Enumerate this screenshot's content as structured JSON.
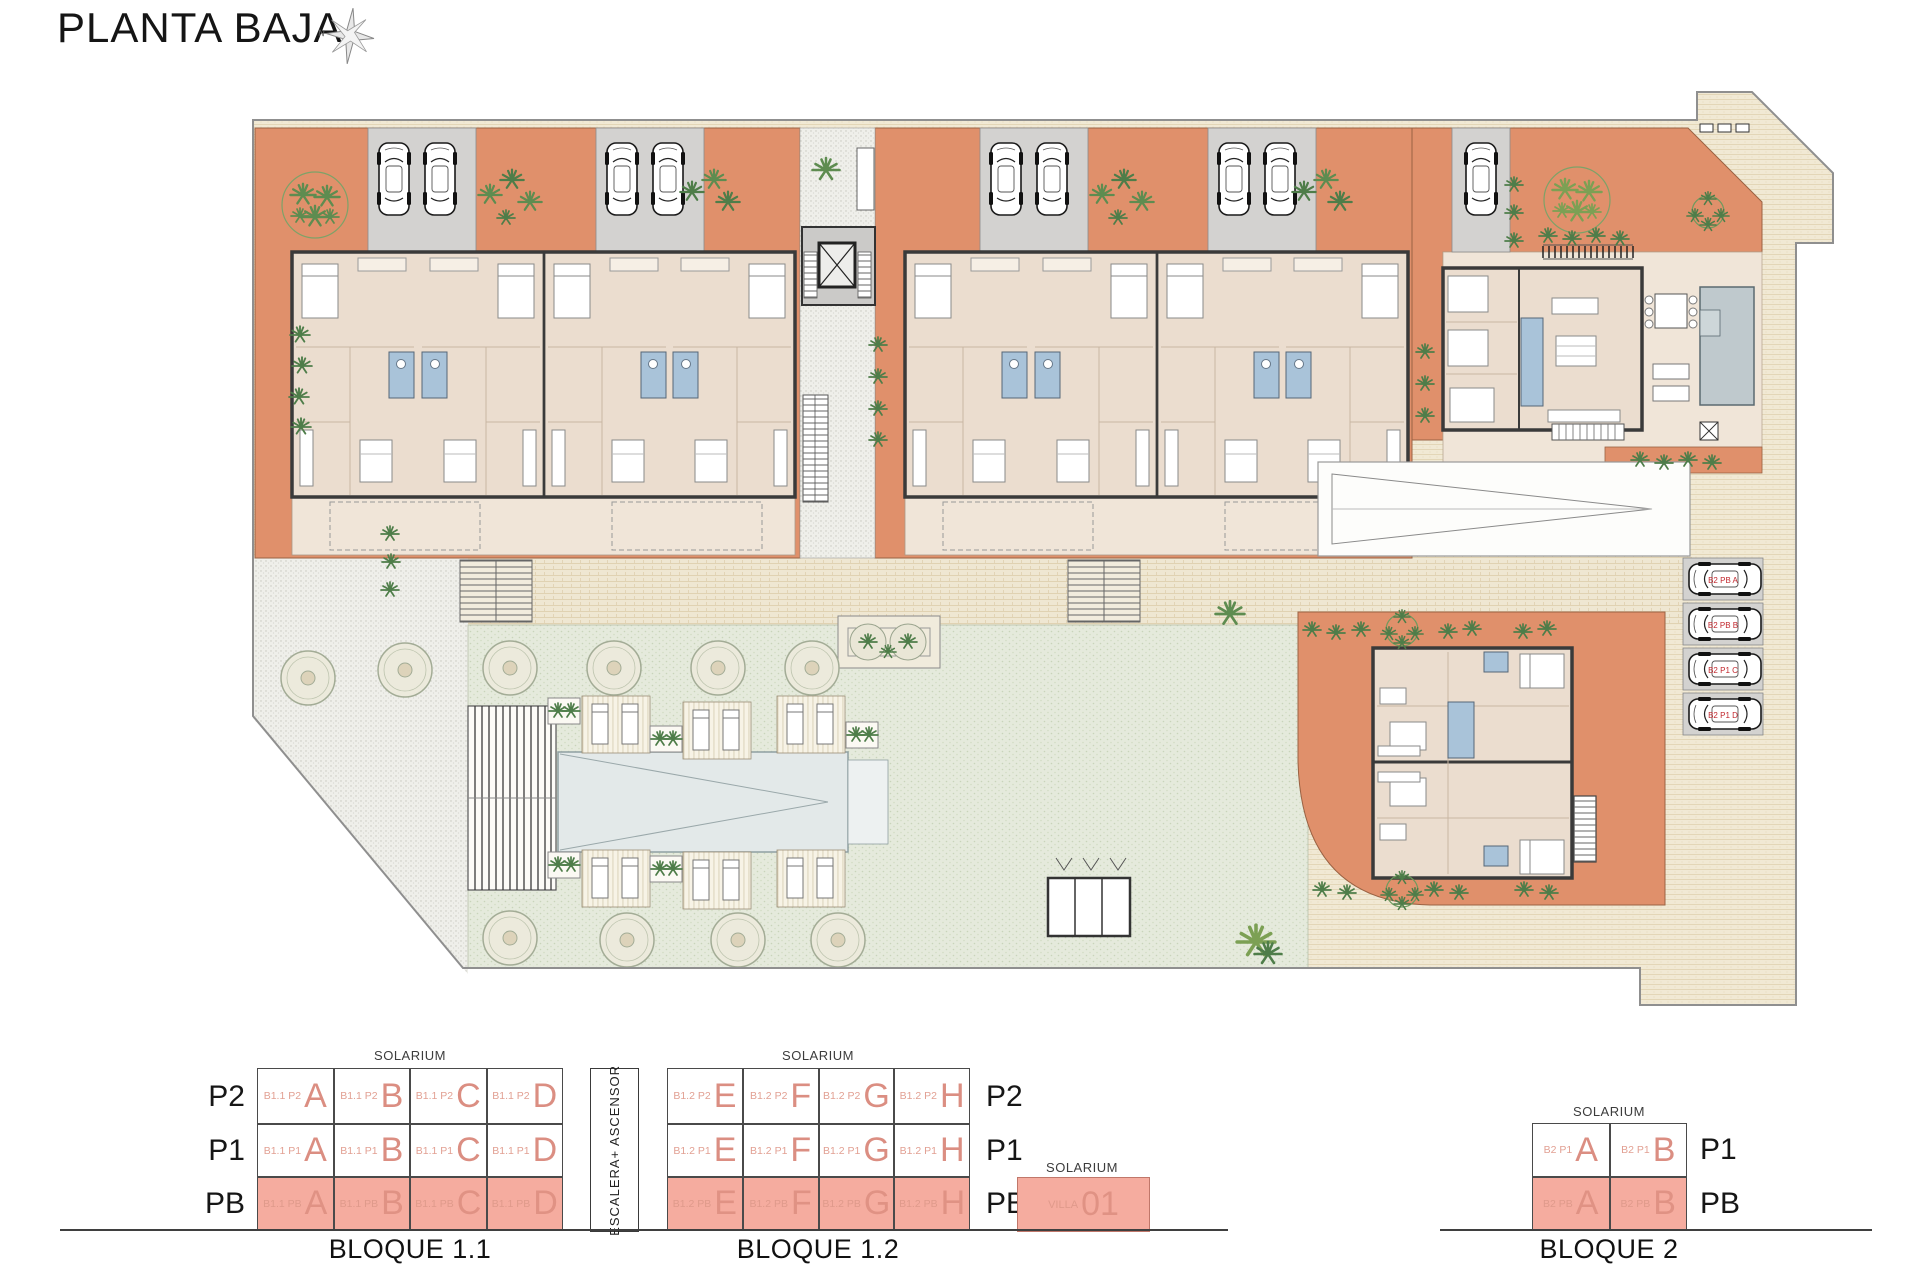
{
  "title": "PLANTA BAJA",
  "compass": {
    "north": "N"
  },
  "plan": {
    "car_labels": [
      "B2 PB A",
      "B2 PB B",
      "B2 P1 C",
      "B2 P1 D"
    ]
  },
  "legend": {
    "bloque_1_1": {
      "solarium": "SOLARIUM",
      "name": "BLOQUE 1.1",
      "floors": [
        "P2",
        "P1",
        "PB"
      ],
      "rows": [
        {
          "cells": [
            {
              "code": "B1.1 P2",
              "letter": "A"
            },
            {
              "code": "B1.1 P2",
              "letter": "B"
            },
            {
              "code": "B1.1 P2",
              "letter": "C"
            },
            {
              "code": "B1.1 P2",
              "letter": "D"
            }
          ]
        },
        {
          "cells": [
            {
              "code": "B1.1 P1",
              "letter": "A"
            },
            {
              "code": "B1.1 P1",
              "letter": "B"
            },
            {
              "code": "B1.1 P1",
              "letter": "C"
            },
            {
              "code": "B1.1 P1",
              "letter": "D"
            }
          ]
        },
        {
          "cells": [
            {
              "code": "B1.1 PB",
              "letter": "A"
            },
            {
              "code": "B1.1 PB",
              "letter": "B"
            },
            {
              "code": "B1.1 PB",
              "letter": "C"
            },
            {
              "code": "B1.1 PB",
              "letter": "D"
            }
          ]
        }
      ]
    },
    "stair_core": {
      "label": "ESCALERA+ ASCENSOR"
    },
    "bloque_1_2": {
      "solarium": "SOLARIUM",
      "name": "BLOQUE 1.2",
      "floors": [
        "P2",
        "P1",
        "PB"
      ],
      "rows": [
        {
          "cells": [
            {
              "code": "B1.2 P2",
              "letter": "E"
            },
            {
              "code": "B1.2 P2",
              "letter": "F"
            },
            {
              "code": "B1.2 P2",
              "letter": "G"
            },
            {
              "code": "B1.2 P2",
              "letter": "H"
            }
          ]
        },
        {
          "cells": [
            {
              "code": "B1.2 P1",
              "letter": "E"
            },
            {
              "code": "B1.2 P1",
              "letter": "F"
            },
            {
              "code": "B1.2 P1",
              "letter": "G"
            },
            {
              "code": "B1.2 P1",
              "letter": "H"
            }
          ]
        },
        {
          "cells": [
            {
              "code": "B1.2 PB",
              "letter": "E"
            },
            {
              "code": "B1.2 PB",
              "letter": "F"
            },
            {
              "code": "B1.2 PB",
              "letter": "G"
            },
            {
              "code": "B1.2 PB",
              "letter": "H"
            }
          ]
        }
      ]
    },
    "villa": {
      "solarium": "SOLARIUM",
      "code": "VILLA",
      "number": "01"
    },
    "bloque_2": {
      "solarium": "SOLARIUM",
      "name": "BLOQUE 2",
      "floors": [
        "P1",
        "PB"
      ],
      "rows": [
        {
          "cells": [
            {
              "code": "B2 P1",
              "letter": "A"
            },
            {
              "code": "B2 P1",
              "letter": "B"
            }
          ]
        },
        {
          "cells": [
            {
              "code": "B2 PB",
              "letter": "A"
            },
            {
              "code": "B2 PB",
              "letter": "B"
            }
          ]
        }
      ]
    }
  },
  "colors": {
    "terrace_orange": "#E0906B",
    "salmon_fill": "#F5AC9F",
    "unit_letter_pink": "#DB8E82",
    "bath_blue": "#A9C3D9",
    "villa_pool_blue": "#BFC9CD",
    "lawn_green": "#E4E9DB",
    "car_label_red": "#C1272D"
  }
}
